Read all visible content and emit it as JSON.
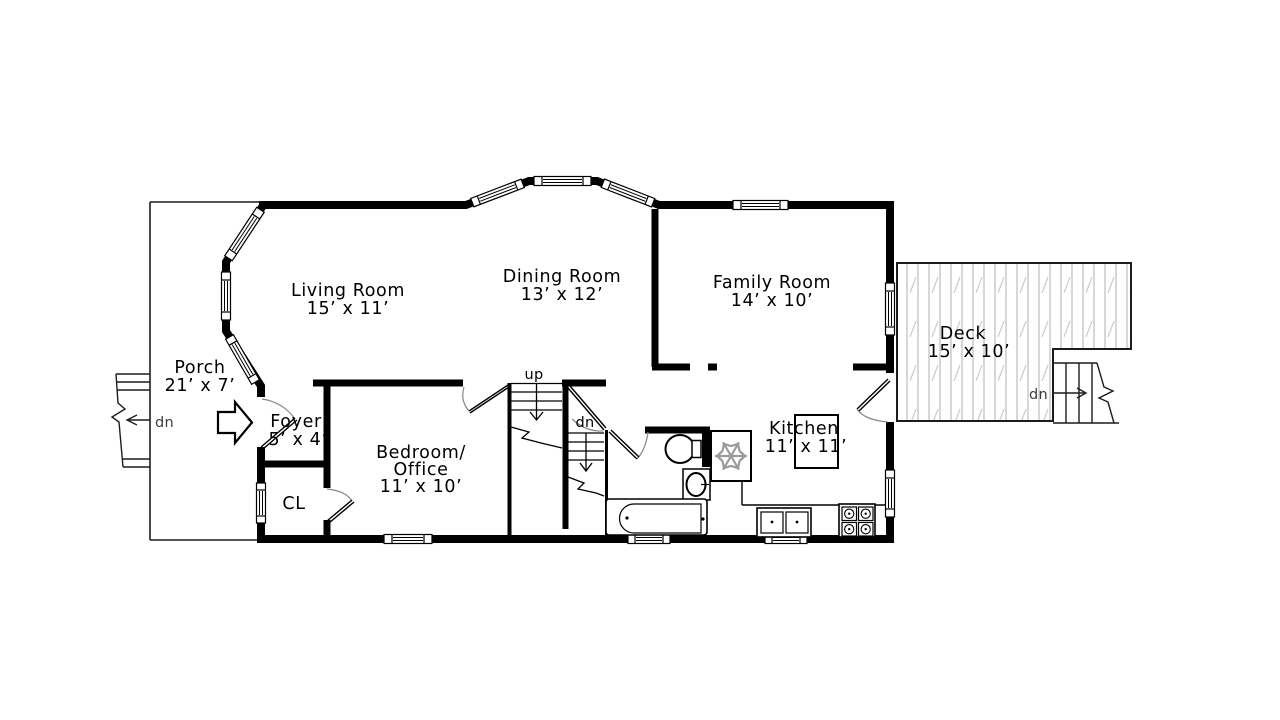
{
  "plan": {
    "title": "First floor plan",
    "rooms": {
      "living": {
        "name": "Living Room",
        "dims": "15’ x 11’"
      },
      "dining": {
        "name": "Dining Room",
        "dims": "13’ x 12’"
      },
      "family": {
        "name": "Family Room",
        "dims": "14’ x 10’"
      },
      "porch": {
        "name": "Porch",
        "dims": "21’ x 7’"
      },
      "foyer": {
        "name": "Foyer",
        "dims": "5’ x 4’"
      },
      "bedroom": {
        "line1": "Bedroom/",
        "line2": "Office",
        "dims": "11’ x 10’"
      },
      "closet": {
        "name": "CL"
      },
      "kitchen": {
        "name": "Kitchen",
        "dims": "11’ x 11’"
      },
      "deck": {
        "name": "Deck",
        "dims": "15’ x 10’"
      }
    },
    "stairs": {
      "up_label": "up",
      "basement_down_label": "dn",
      "porch_down_label": "dn",
      "deck_down_label": "dn"
    },
    "icons": {
      "entry_arrow": "entry-direction-arrow",
      "snowflake": "refrigerator-snowflake",
      "fixtures": [
        "toilet",
        "bathroom-sink",
        "bathtub",
        "kitchen-sink",
        "stove",
        "refrigerator"
      ]
    },
    "colors": {
      "wall": "#000000",
      "deck_hatch": "#c6c6c6",
      "outdoor_label": "#3c3c3c",
      "snowflake": "#9a9a9a"
    }
  }
}
